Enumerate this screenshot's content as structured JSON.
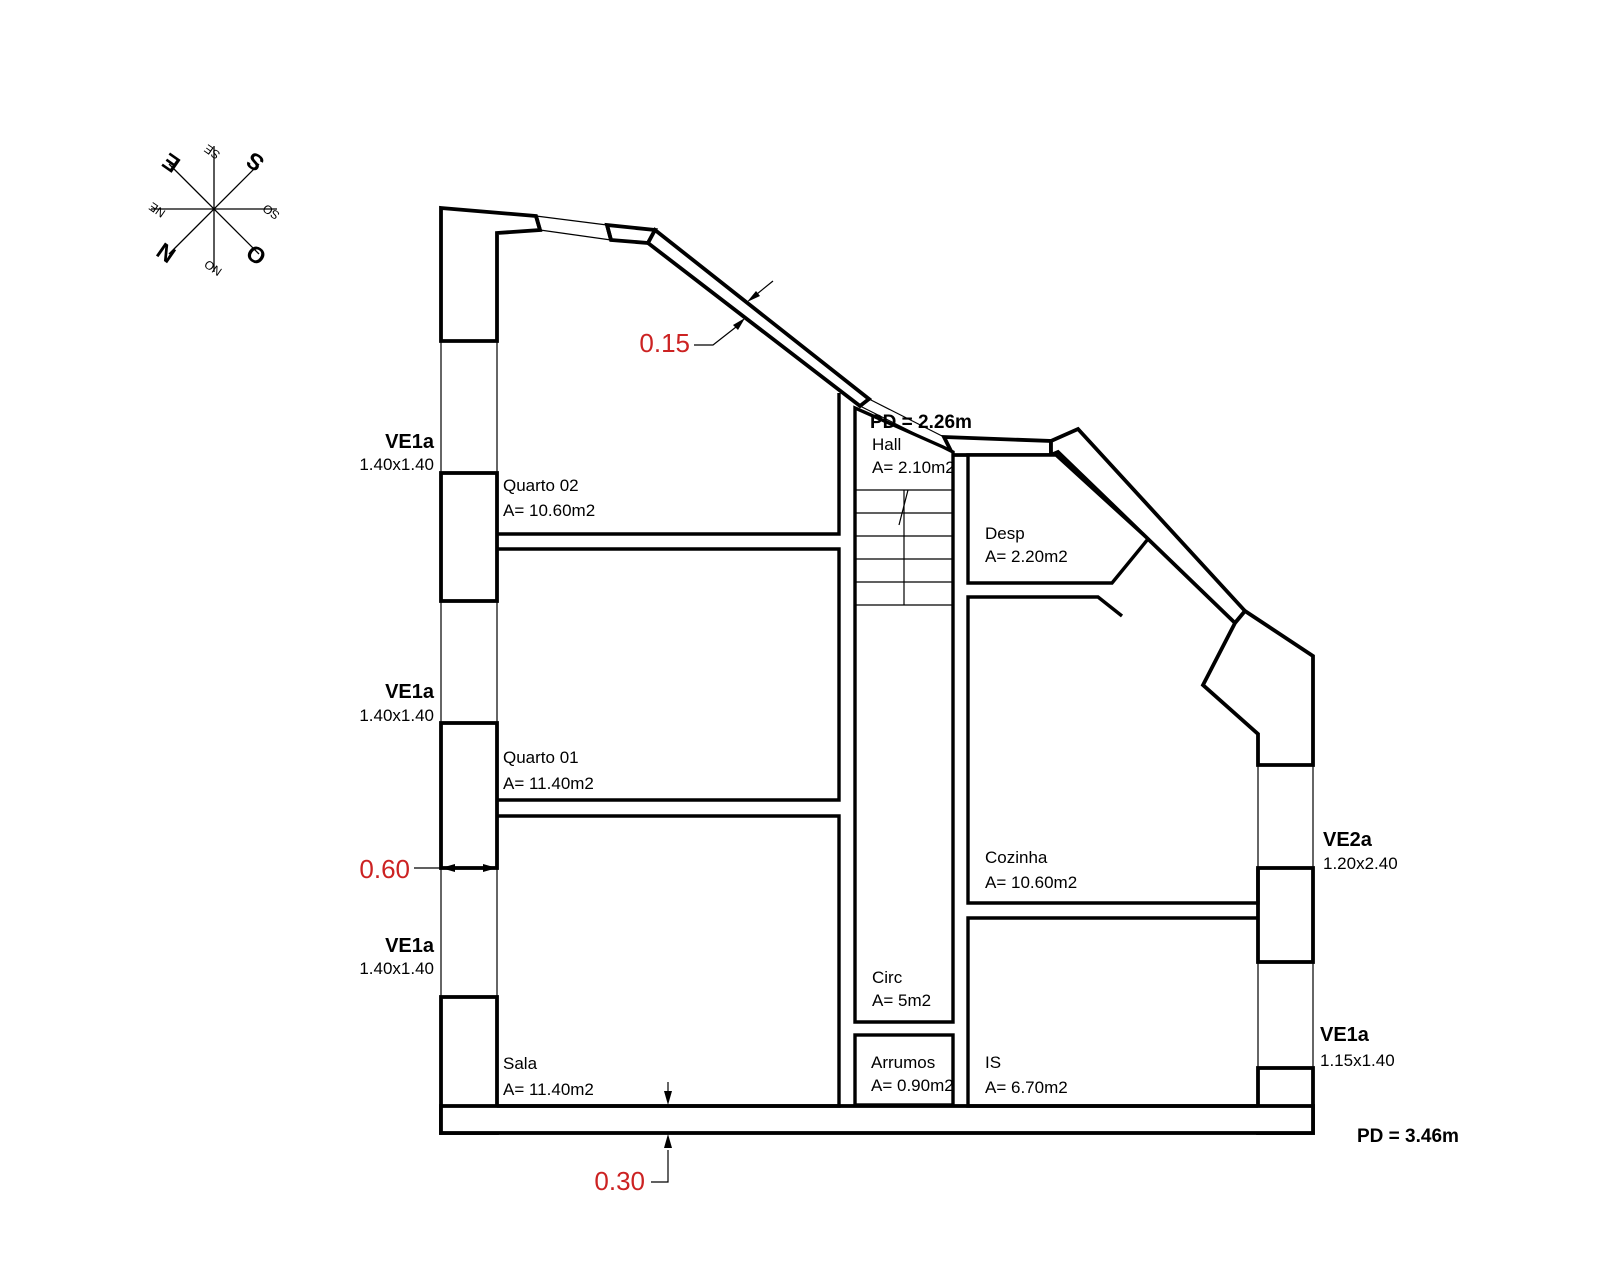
{
  "drawing": {
    "compass": {
      "n": "N",
      "s": "S",
      "e": "E",
      "o": "O",
      "ne": "NE",
      "se": "SE",
      "so": "SO",
      "no": "NO"
    },
    "rooms": {
      "quarto02": {
        "name": "Quarto 02",
        "area": "A= 10.60m2"
      },
      "quarto01": {
        "name": "Quarto 01",
        "area": "A= 11.40m2"
      },
      "sala": {
        "name": "Sala",
        "area": "A= 11.40m2"
      },
      "hall": {
        "name": "Hall",
        "area": "A= 2.10m2"
      },
      "circ": {
        "name": "Circ",
        "area": "A= 5m2"
      },
      "arrumos": {
        "name": "Arrumos",
        "area": "A= 0.90m2"
      },
      "is": {
        "name": "IS",
        "area": "A= 6.70m2"
      },
      "cozinha": {
        "name": "Cozinha",
        "area": "A= 10.60m2"
      },
      "desp": {
        "name": "Desp",
        "area": "A= 2.20m2"
      }
    },
    "windows": {
      "left1": {
        "code": "VE1a",
        "size": "1.40x1.40"
      },
      "left2": {
        "code": "VE1a",
        "size": "1.40x1.40"
      },
      "left3": {
        "code": "VE1a",
        "size": "1.40x1.40"
      },
      "right_kitchen": {
        "code": "VE2a",
        "size": "1.20x2.40"
      },
      "right_is": {
        "code": "VE1a",
        "size": "1.15x1.40"
      }
    },
    "dimensions": {
      "diagonal_wall": "0.15",
      "left_wall": "0.60",
      "bottom_wall": "0.30"
    },
    "ceiling_heights": {
      "hall": "PD = 2.26m",
      "main": "PD = 3.46m"
    },
    "colors": {
      "line": "#000000",
      "dimension": "#cc2222"
    }
  }
}
